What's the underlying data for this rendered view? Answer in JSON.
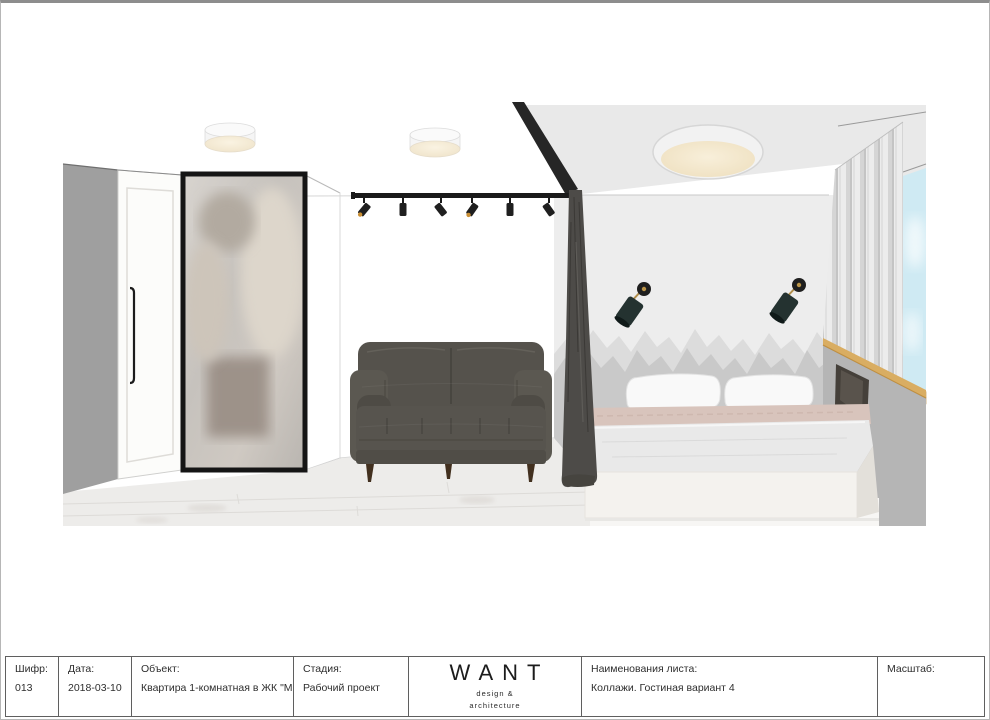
{
  "document": {
    "type": "interior-design-sheet",
    "background": "#ffffff",
    "border_color": "#8d8d8d"
  },
  "titleblock": {
    "fields": [
      {
        "id": "code",
        "label": "Шифр:",
        "value": "013"
      },
      {
        "id": "date",
        "label": "Дата:",
        "value": "2018-03-10"
      },
      {
        "id": "object",
        "label": "Объект:",
        "value": "Квартира 1-комнатная в ЖК \"Май\""
      },
      {
        "id": "stage",
        "label": "Стадия:",
        "value": "Рабочий проект"
      },
      {
        "id": "sheet",
        "label": "Наименования листа:",
        "value": "Коллажи. Гостиная вариант 4"
      },
      {
        "id": "scale",
        "label": "Масштаб:",
        "value": ""
      }
    ],
    "logo": {
      "title": "WANT",
      "subtitle_line1": "design &",
      "subtitle_line2": "architecture"
    }
  },
  "collage": {
    "scene": "Living room with corner wardrobe, framed mirror, track lighting, grey velvet sofa, dark room-divider curtain; bedroom with round ceiling lamp, two black wall sconces, grey mountain wall mural, double bed, grey half-wall with niche, sheer curtain and window",
    "elements": [
      "left-wall",
      "wardrobe-door",
      "mirror",
      "ceiling-lamp-small-1",
      "ceiling-lamp-small-2",
      "track-light",
      "sofa",
      "ceiling-beam",
      "room-divider-curtain",
      "bedroom-ceiling",
      "bedroom-wall",
      "mountain-mural",
      "wall-sconce-left",
      "wall-sconce-right",
      "ceiling-lamp-large",
      "bed",
      "partition-wall",
      "tv-niche",
      "wood-trim",
      "window-curtain",
      "window-sky",
      "floor"
    ],
    "colors": {
      "left_wall": "#9f9f9f",
      "wardrobe": "#fcfcfa",
      "mirror_frame": "#151515",
      "sofa": "#55524c",
      "divider_curtain": "#4d4b48",
      "bedroom_ceiling": "#e9e9e9",
      "bedroom_wall": "#ededed",
      "mountain_back": "#dcdcdc",
      "mountain_front": "#c9c9c9",
      "sconce_shade": "#243230",
      "sconce_brass": "#b08d4a",
      "lamp_glow": "#f5e9cf",
      "bed_blanket": "#d8c4bc",
      "partition": "#b5b5b5",
      "niche": "#45403a",
      "wood_trim": "#d9ad62",
      "sky": "#cfeaf3",
      "floor": "#edecea",
      "track_black": "#1a1a1a"
    }
  }
}
